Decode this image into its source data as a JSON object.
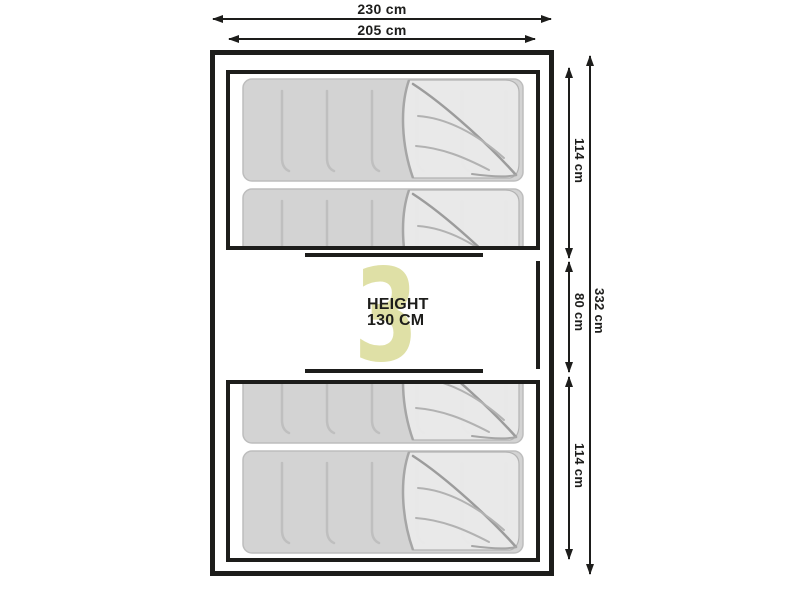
{
  "diagram": {
    "type": "tent-floorplan",
    "watermark_number": "3",
    "center_label": {
      "line1": "HEIGHT",
      "line2": "130 CM"
    },
    "dimensions": {
      "outer_width": "230 cm",
      "inner_width": "205 cm",
      "top_bedroom_depth": "114 cm",
      "middle_section_depth": "80 cm",
      "bottom_bedroom_depth": "114 cm",
      "total_depth": "332 cm"
    },
    "colors": {
      "line": "#1d1d1b",
      "mattress_body": "#d3d3d3",
      "mattress_flap": "#ebebeb",
      "watermark": "#dfe0a6"
    }
  }
}
